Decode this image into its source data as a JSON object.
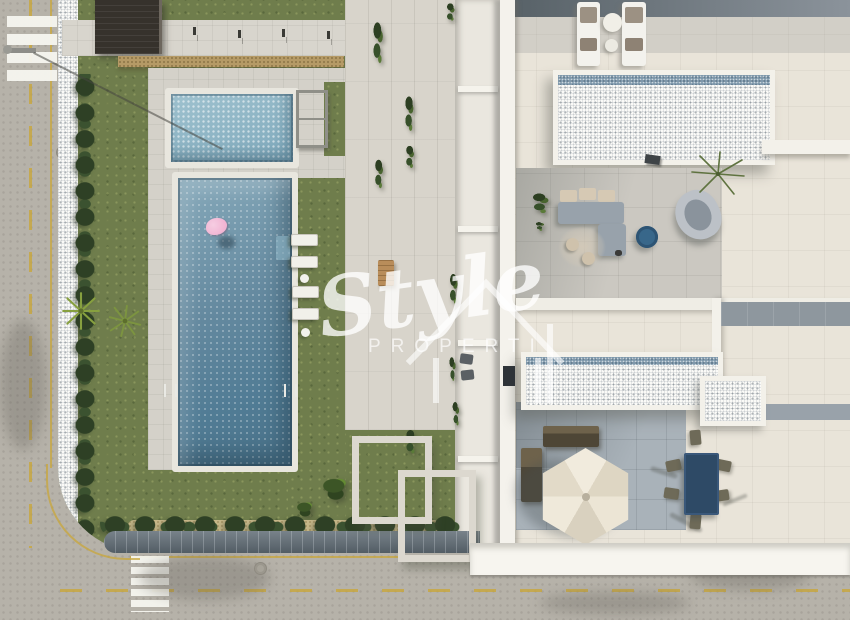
{
  "watermark": {
    "script_text": "Style",
    "caption_text": "PROPERTI",
    "icon": "house-outline-icon"
  },
  "palette": {
    "grass_green": "#6f7d4c",
    "hedge_green": "#2e4025",
    "pool_blue": "#5d87a0",
    "kids_pool_blue": "#8fb6c6",
    "flamingo_pink": "#efa9cc",
    "road_gray": "#b6b2a9",
    "lane_yellow": "#c9a73b",
    "deck_gray": "#d4d1c9",
    "cream_tile": "#e9e4d9",
    "terrace_gray": "#cbc8c1",
    "terrace_blue_gray": "#a9b2b9",
    "gravel_white": "#fafaf7",
    "mosaic_blue": "#7e98ab",
    "wood_dark": "#4e4636",
    "table_navy": "#2e4a66",
    "umbrella_cream": "#ece5d5",
    "walkway_white": "#f7f5ef"
  }
}
